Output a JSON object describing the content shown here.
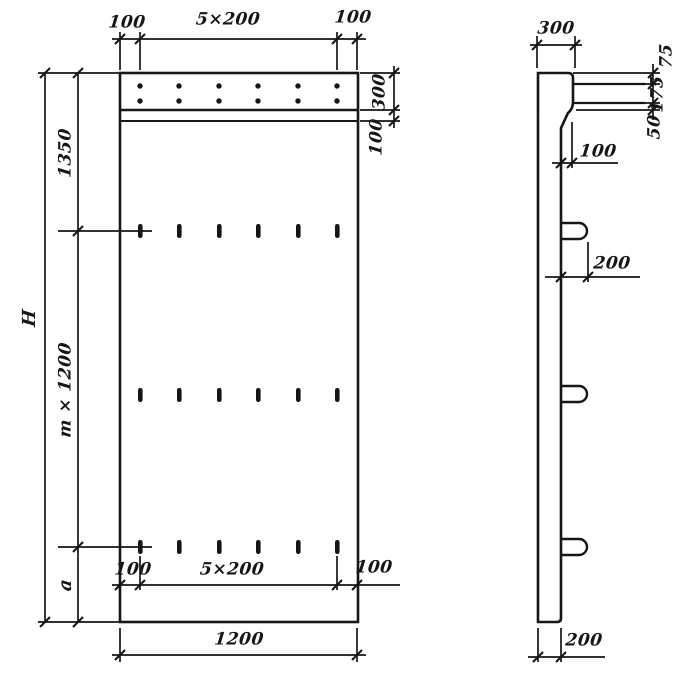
{
  "colors": {
    "ink": "#161616",
    "paper": "#ffffff"
  },
  "front_view": {
    "top_dimension": {
      "left": "100",
      "center": "5×200",
      "right": "100"
    },
    "right_dimension": {
      "strip": "300",
      "band": "100"
    },
    "left_dimension": {
      "overall_height": "H",
      "top_segment": "1350",
      "middle_segment": "m × 1200",
      "bottom_segment": "a"
    },
    "inner_bottom_dimension": {
      "left": "100",
      "center": "5×200",
      "right": "100"
    },
    "overall_width": "1200",
    "dowel_dots": {
      "rows": 2,
      "columns": 6
    },
    "slot_marks": {
      "rows": 3,
      "columns": 6
    }
  },
  "side_view": {
    "top_width": "300",
    "head_dimensions": {
      "top": "75",
      "middle": "175",
      "bottom": "50"
    },
    "step": "100",
    "hook_length": "200",
    "thickness": "200",
    "hooks_count": 3
  }
}
